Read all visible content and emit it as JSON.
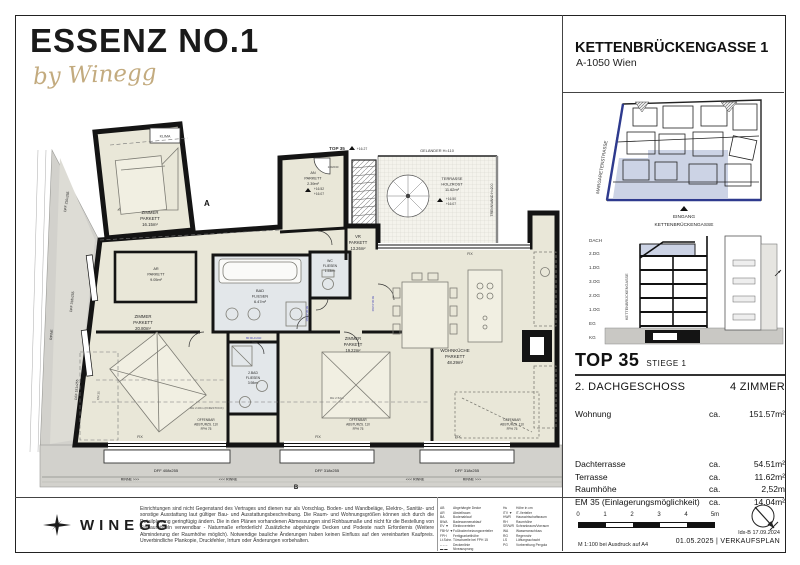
{
  "header": {
    "title": "ESSENZ NO.1",
    "byline": "by Winegg",
    "address_line1": "KETTENBRÜCKENGASSE 1",
    "address_line2": "A-1050 Wien"
  },
  "sitemap": {
    "street_left": "MARGARETENSTRASSE",
    "entrance_label": "EINGANG",
    "entrance_street": "KETTENBRÜCKENGASSE",
    "highlight_color": "#ccd3e5",
    "street_color": "#2e3a8e"
  },
  "section": {
    "floors": [
      "DACH",
      "2.DG",
      "1.DG",
      "3.OG",
      "2.OG",
      "1.OG",
      "EG",
      "KG"
    ],
    "street_label": "KETTENBRÜCKENGASSE",
    "highlight_color": "#ccd3e5"
  },
  "unit": {
    "top": "TOP 35",
    "stiege": "STIEGE 1",
    "floor": "2. DACHGESCHOSS",
    "rooms_count": "4 ZIMMER",
    "wohnung": {
      "label": "Wohnung",
      "ca": "ca.",
      "value": "151.57m²"
    },
    "details": [
      {
        "label": "Dachterrasse",
        "ca": "ca.",
        "value": "54.51m²"
      },
      {
        "label": "Terrasse",
        "ca": "ca.",
        "value": "11.62m²"
      },
      {
        "label": "Raumhöhe",
        "ca": "ca.",
        "value": "2,52m"
      },
      {
        "label": "EM 35 (Einlagerungsmöglichkeit)",
        "ca": "ca.",
        "value": "14.04m²"
      }
    ]
  },
  "plan": {
    "rooms": [
      {
        "name": "ZIMMER",
        "finish": "PARKETT",
        "area": "16.15m²"
      },
      {
        "name": "AR",
        "finish": "PARKETT",
        "area": "9.05m²"
      },
      {
        "name": "AN",
        "finish": "PARKETT",
        "area": "2.39m²"
      },
      {
        "name": "VR",
        "finish": "PARKETT",
        "area": "13.26m²"
      },
      {
        "name": "BAD",
        "finish": "FLIESEN",
        "area": "6.47m²"
      },
      {
        "name": "WC",
        "finish": "FLIESEN",
        "area": "1.53m²"
      },
      {
        "name": "ZIMMER",
        "finish": "PARKETT",
        "area": "20.80m²"
      },
      {
        "name": "2.BAD",
        "finish": "FLIESEN",
        "area": "3.98m²"
      },
      {
        "name": "ZIMMER",
        "finish": "PARKETT",
        "area": "19.22m²"
      },
      {
        "name": "WOHNKÜCHE",
        "finish": "PARKETT",
        "area": "48.29m²"
      },
      {
        "name": "TERRASSE",
        "finish": "HOLZROST",
        "area": "11.62m²"
      }
    ],
    "labels": {
      "top_unit": "TOP 35",
      "klima": "KLIMA",
      "gelaender": "GELÄNDER H=110",
      "trennwand": "TRENNWAND H=200",
      "fix": "FIX",
      "offenbar1": "OFFENBAR",
      "offenbar2": "ABSTURZS. 110",
      "fph": "FPH 75",
      "dff_b1": "DFF 408x255",
      "dff_b2": "DFF 318x255",
      "dff_b3": "DFF 318x255",
      "dff_l1": "DFF 210x255",
      "dff_l2": "DFF 318x255",
      "dff_l3": "DFF 181x255",
      "rinne_r": "RINNE >>>",
      "rinne_l": "<<< RINNE",
      "rinne": "RINNE",
      "door_size": "80 RH=240",
      "entry_size": "100/230",
      "lvl_an_top": "+16.52",
      "lvl_an_bottom": "+16.07",
      "lvl_terr_top": "+16.50",
      "lvl_terr_bottom": "+16.07",
      "lvl_entry": "+16.27",
      "rh_mid": "RH 2.52m",
      "rh_knee": "RH 2.00m (KNIESTOCK)",
      "em": "EM 35",
      "marker_a": "A",
      "marker_b": "B"
    },
    "colors": {
      "floor": "#e9e7d8",
      "tile": "#e3e7ea",
      "wall": "#141414",
      "roof": "#d2d1cc",
      "accent_blue": "#4545b5"
    }
  },
  "footer": {
    "brand": "WINEGG",
    "disclaimer": "Einrichtungen sind nicht Gegenstand des Vertrages und dienen nur als Vorschlag. Boden- und Wandbeläge, Elektro-, Sanitär- und sonstige Ausstattung laut gültiger Bau- und Ausstattungsbeschreibung. Die Raum- und Wohnungsgrößen können sich durch die Detailplanung geringfügig ändern. Die in den Plänen vorhandenen Abmessungen sind Rohbaumaße und nicht für die Bestellung von Einbaumöbeln verwendbar - Naturmaße erforderlich! Zusätzliche abgehängte Decken und Podeste nach Erfordernis (Weitere Abminderung der Raumhöhe möglich). Notwendige bauliche Änderungen haben keinen Einfluss auf den vereinbarten Kaufpreis. Unverbindliche Plankopie, Druckfehler, Irrtum oder Änderungen vorbehalten.",
    "legend_left": [
      [
        "AB",
        "Abgehängte Decke"
      ],
      [
        "AR",
        "Abstellraum"
      ],
      [
        "BA",
        "Bodenablauf"
      ],
      [
        "BWA",
        "Badewannenablauf"
      ],
      [
        "EV ▼",
        "Elektroverteiler"
      ],
      [
        "FBHV ▼",
        "Fußbodenheizungsverteiler"
      ],
      [
        "FPH",
        "Fertigparketthöhe"
      ],
      [
        "Lt.Schn.",
        "Türschwelle bei FPH 15"
      ],
      [
        "– – –",
        "Deckenlinie"
      ],
      [
        "▬ ▬",
        "Niveausprung"
      ]
    ],
    "legend_right": [
      [
        "Hu",
        "Höhe in cm"
      ],
      [
        "ITV ▼",
        "IT-Verteiler"
      ],
      [
        "HWR",
        "Hauswirtschaftsraum"
      ],
      [
        "RH",
        "Raumhöhe"
      ],
      [
        "SR/WR",
        "Schrankraum/Vorraum"
      ],
      [
        "WA",
        "Wasseranschluss"
      ],
      [
        "RG",
        "Regenrohr"
      ],
      [
        "LS",
        "Lüftungsschacht"
      ],
      [
        "PG",
        "Vorbereitung Pergola"
      ]
    ],
    "scale_ticks": [
      "0",
      "1",
      "2",
      "3",
      "4",
      "5m"
    ],
    "scale_note": "M 1:100 bei Ausdruck auf A4",
    "index_line1": "Idx-B 17.09.2024",
    "index_line2": "01.05.2025  |  VERKAUFSPLAN"
  }
}
